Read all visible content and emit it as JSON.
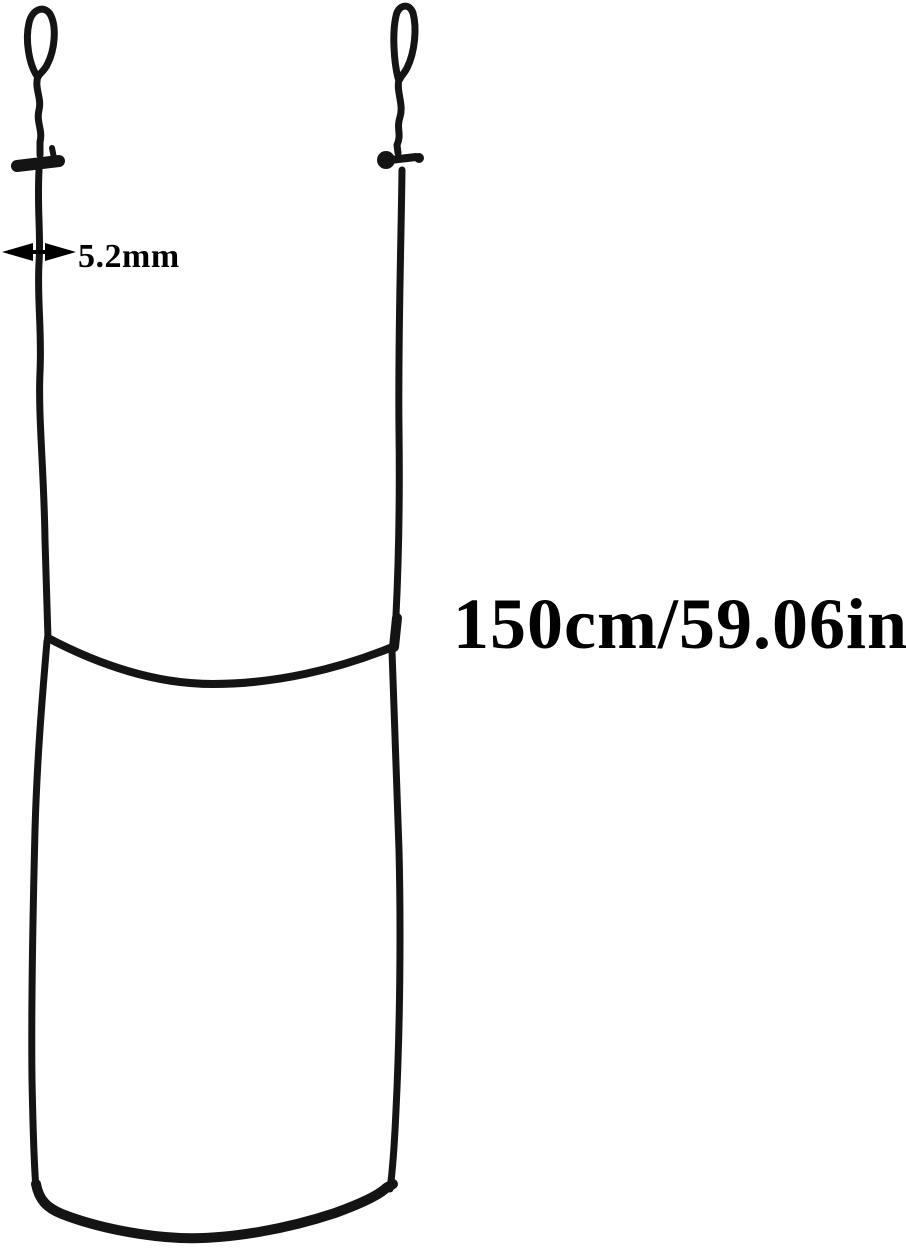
{
  "image": {
    "background_color": "#ffffff",
    "cord_color": "#141414",
    "text_color": "#000000"
  },
  "annotations": {
    "thickness": {
      "label": "5.2mm",
      "icon": "horizontal-double-arrow-icon"
    },
    "length": {
      "label": "150cm/59.06in"
    }
  }
}
